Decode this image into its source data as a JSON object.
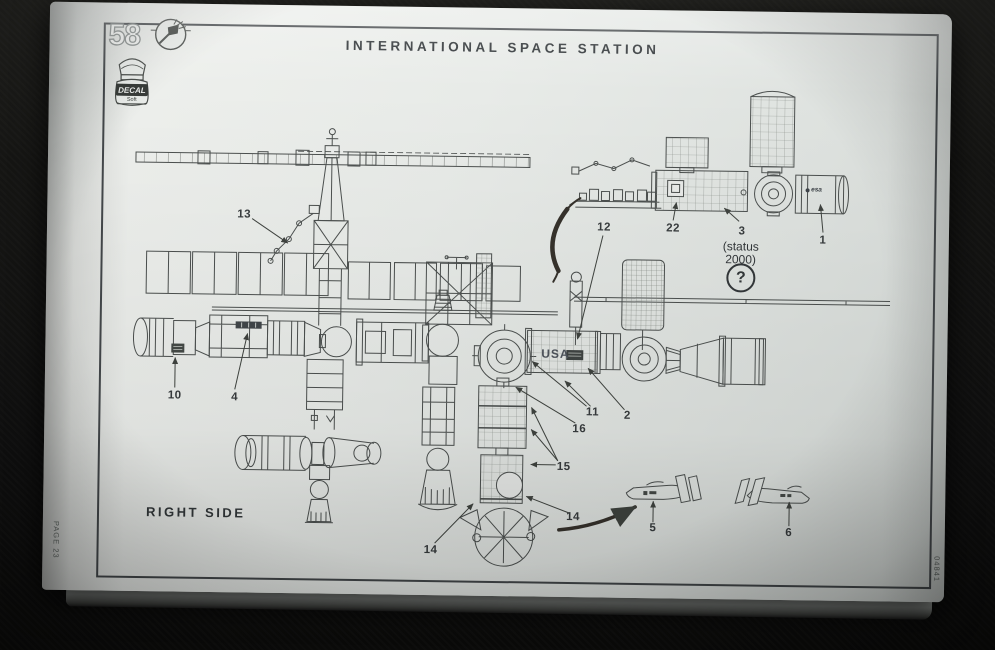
{
  "page": {
    "step_number": "58",
    "title": "INTERNATIONAL SPACE STATION",
    "view_label": "RIGHT SIDE",
    "page_label": "PAGE 23",
    "kit_number": "04841",
    "decal_bottle": {
      "label": "DECAL",
      "sub_label": "Soft"
    },
    "status_note": {
      "line1": "(status",
      "line2": "2000)",
      "symbol": "?"
    },
    "markings": {
      "usa": "USA",
      "esa": "esa"
    },
    "callouts": [
      {
        "part": "13"
      },
      {
        "part": "12"
      },
      {
        "part": "22"
      },
      {
        "part": "3"
      },
      {
        "part": "1"
      },
      {
        "part": "10"
      },
      {
        "part": "4"
      },
      {
        "part": "11"
      },
      {
        "part": "2"
      },
      {
        "part": "16"
      },
      {
        "part": "15"
      },
      {
        "part": "14"
      },
      {
        "part": "14"
      },
      {
        "part": "5"
      },
      {
        "part": "6"
      }
    ],
    "colors": {
      "paper": "#e8ebe8",
      "ink": "#4c504f",
      "background": "#141412",
      "swoosh": "#36322c"
    }
  }
}
